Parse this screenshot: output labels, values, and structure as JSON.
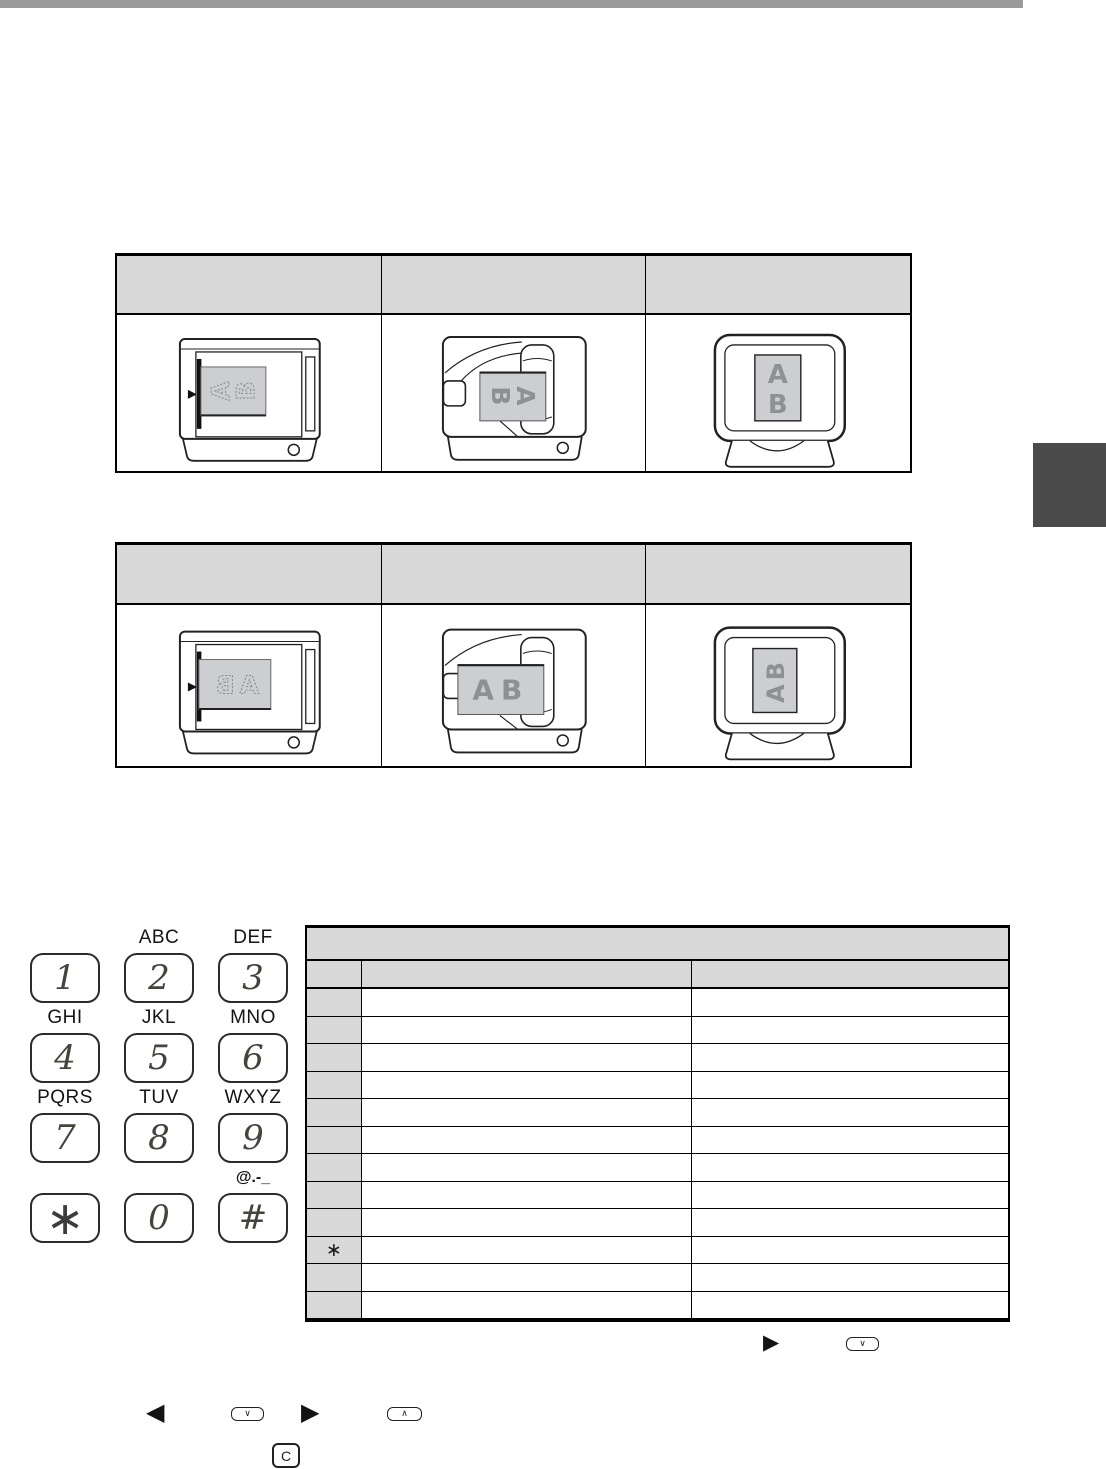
{
  "colors": {
    "header_gray": "#d8d8d8",
    "top_bar_gray": "#9a9a9a",
    "side_tab_dark": "#4b4b4b",
    "paper_gray": "#cdced2",
    "letter_gray": "#8f9094"
  },
  "orientation_tables": {
    "table1": {
      "headers": [
        "",
        "",
        ""
      ]
    },
    "table2": {
      "headers": [
        "",
        "",
        ""
      ]
    }
  },
  "diagrams": {
    "letter_a": "A",
    "letter_b": "B",
    "word_ab": "AB"
  },
  "keypad": {
    "keys": [
      {
        "digit": "1",
        "label": ""
      },
      {
        "digit": "2",
        "label": "ABC"
      },
      {
        "digit": "3",
        "label": "DEF"
      },
      {
        "digit": "4",
        "label": "GHI"
      },
      {
        "digit": "5",
        "label": "JKL"
      },
      {
        "digit": "6",
        "label": "MNO"
      },
      {
        "digit": "7",
        "label": "PQRS"
      },
      {
        "digit": "8",
        "label": "TUV"
      },
      {
        "digit": "9",
        "label": "WXYZ"
      },
      {
        "digit": "∗",
        "label": ""
      },
      {
        "digit": "0",
        "label": ""
      },
      {
        "digit": "#",
        "label": "@.-_"
      }
    ]
  },
  "char_table": {
    "title": "",
    "col_headers": [
      "",
      "",
      ""
    ],
    "key_column": [
      "",
      "",
      "",
      "",
      "",
      "",
      "",
      "",
      "",
      "∗",
      "",
      ""
    ]
  },
  "icons": {
    "triangle_right": "▶",
    "triangle_left": "◀",
    "chevron_down": "∨",
    "chevron_up": "∧",
    "clear_key": "C"
  }
}
